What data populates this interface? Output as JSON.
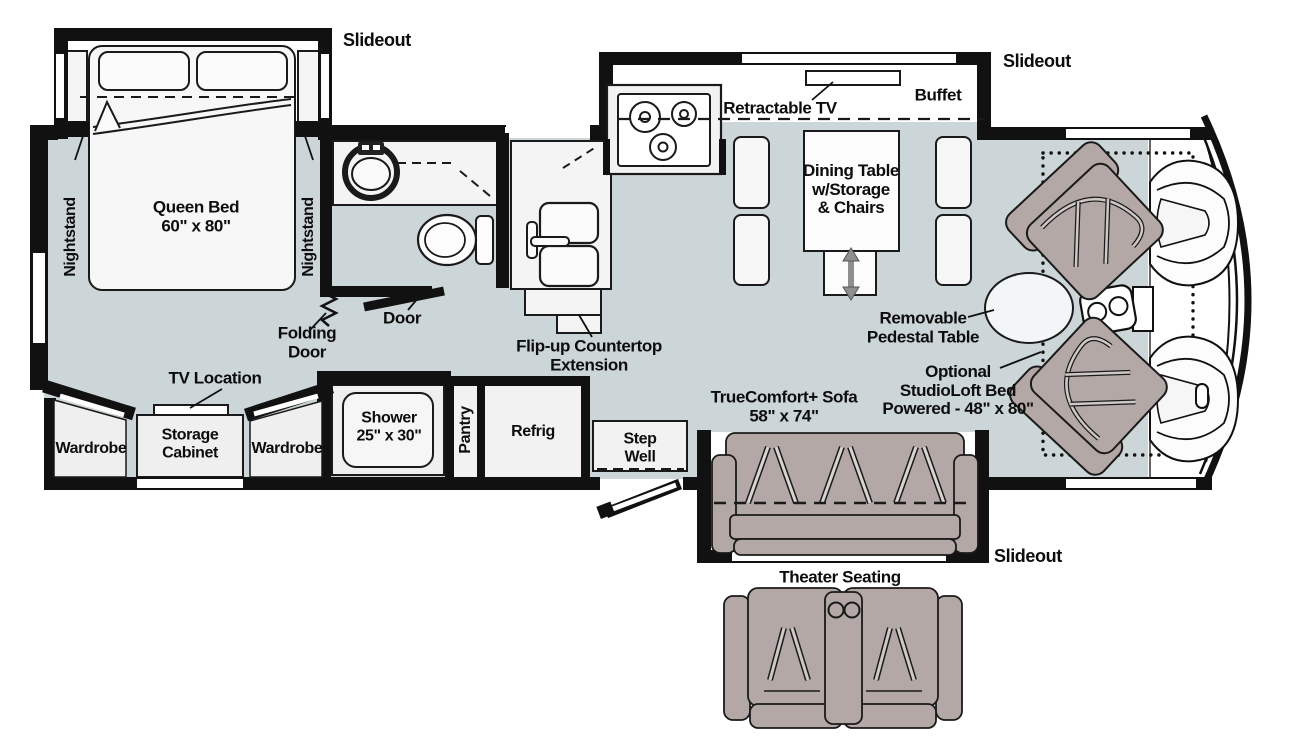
{
  "colors": {
    "floor": "#ccd5d7",
    "wall": "#111111",
    "furniture": "#f2f2f2",
    "upholstery": "#b3a8a5",
    "outline": "#1a1a1a",
    "white": "#ffffff"
  },
  "labels": {
    "slideout_bedroom": "Slideout",
    "slideout_kitchen": "Slideout",
    "slideout_sofa": "Slideout",
    "nightstand_left": "Nightstand",
    "nightstand_right": "Nightstand",
    "queen_bed": "Queen Bed\n60\" x 80\"",
    "folding_door": "Folding\nDoor",
    "bath_door": "Door",
    "flip_up_countertop": "Flip-up Countertop\nExtension",
    "retractable_tv": "Retractable TV",
    "buffet": "Buffet",
    "dining_table": "Dining Table\nw/Storage\n& Chairs",
    "removable_pedestal_table": "Removable\nPedestal Table",
    "optional_studioloft_bed": "Optional\nStudioLoft Bed\nPowered - 48\" x 80\"",
    "truecomfort_sofa": "TrueComfort+ Sofa\n58\" x 74\"",
    "tv_location": "TV Location",
    "wardrobe_left": "Wardrobe",
    "storage_cabinet": "Storage\nCabinet",
    "wardrobe_right": "Wardrobe",
    "shower": "Shower\n25\" x 30\"",
    "pantry": "Pantry",
    "refrig": "Refrig",
    "step_well": "Step\nWell",
    "theater_seating": "Theater Seating"
  }
}
